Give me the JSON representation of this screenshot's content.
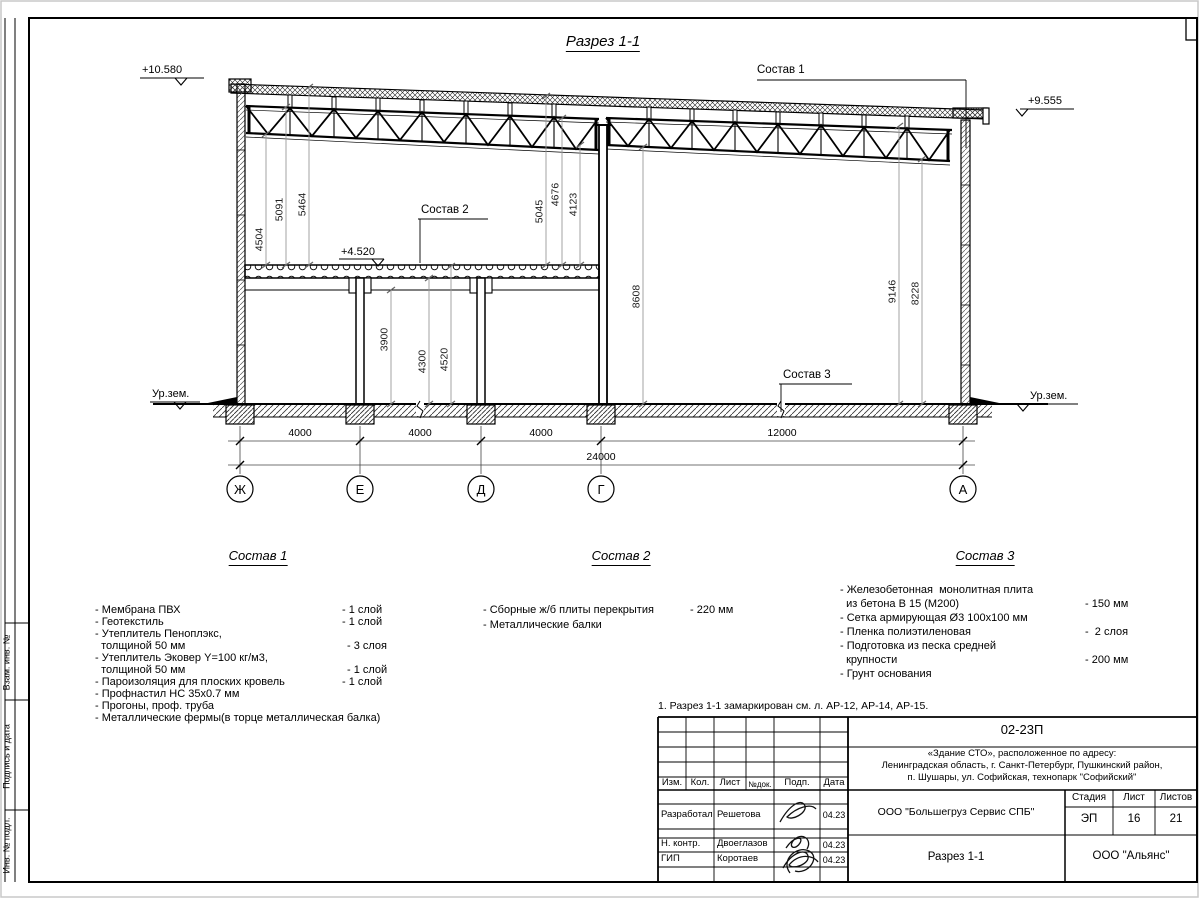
{
  "sheet": {
    "title": "Разрез 1-1",
    "note": "1. Разрез 1-1 замаркирован см. л. АР-12, АР-14, АР-15.",
    "margin_labels": [
      "Взам. инв. №",
      "Подпись и дата",
      "Инв. № подл."
    ]
  },
  "drawing": {
    "elevations": {
      "roof_left": "+10.580",
      "roof_right": "+9.555",
      "slab": "+4.520",
      "ground_left": "Ур.зем.",
      "ground_right": "Ур.зем."
    },
    "callouts": [
      "Состав 1",
      "Состав 2",
      "Состав 3"
    ],
    "vdims": [
      "4504",
      "5091",
      "5464",
      "5045",
      "4676",
      "4123",
      "3900",
      "4300",
      "4520",
      "8608",
      "9146",
      "8228"
    ],
    "hdims": [
      "4000",
      "4000",
      "4000",
      "12000"
    ],
    "total_dim": "24000",
    "axes": [
      "Ж",
      "Е",
      "Д",
      "Г",
      "А"
    ]
  },
  "compositions": [
    {
      "title": "Состав 1",
      "items": [
        {
          "name": "- Мембрана ПВХ",
          "value": "- 1 слой"
        },
        {
          "name": "- Геотекстиль",
          "value": "- 1 слой"
        },
        {
          "name": "- Утеплитель Пеноплэкс,",
          "value": ""
        },
        {
          "name": "  толщиной 50 мм",
          "value": "- 3 слоя"
        },
        {
          "name": "- Утеплитель Эковер Y=100 кг/м3,",
          "value": ""
        },
        {
          "name": "  толщиной 50 мм",
          "value": "- 1 слой"
        },
        {
          "name": "- Пароизоляция для плоских кровель",
          "value": "- 1 слой"
        },
        {
          "name": "- Профнастил НС 35x0.7 мм",
          "value": ""
        },
        {
          "name": "- Прогоны, проф. труба",
          "value": ""
        },
        {
          "name": "- Металлические фермы(в торце металлическая балка)",
          "value": ""
        }
      ]
    },
    {
      "title": "Состав 2",
      "items": [
        {
          "name": "- Сборные ж/б плиты перекрытия",
          "value": "- 220 мм"
        },
        {
          "name": "- Металлические балки",
          "value": ""
        }
      ]
    },
    {
      "title": "Состав 3",
      "items": [
        {
          "name": "- Железобетонная  монолитная плита",
          "value": ""
        },
        {
          "name": "  из бетона В 15 (М200)",
          "value": "- 150 мм"
        },
        {
          "name": "- Сетка армирующая Ø3 100х100 мм",
          "value": ""
        },
        {
          "name": "- Пленка полиэтиленовая",
          "value": "-  2 слоя"
        },
        {
          "name": "- Подготовка из песка средней",
          "value": ""
        },
        {
          "name": "  крупности",
          "value": "- 200 мм"
        },
        {
          "name": "- Грунт основания",
          "value": ""
        }
      ]
    }
  ],
  "title_block": {
    "doc_number": "02-23П",
    "object_line1": "«Здание СТО», расположенное по адресу:",
    "object_line2": "Ленинградская область, г. Санкт-Петербург, Пушкинский район,",
    "object_line3": "п. Шушары, ул. Софийская, технопарк \"Софийский\"",
    "col_headers": [
      "Изм.",
      "Кол.",
      "Лист",
      "№док.",
      "Подп.",
      "Дата"
    ],
    "sign_rows": [
      {
        "role": "Разработал",
        "name": "Решетова",
        "date": "04.23"
      },
      {
        "role": "Н. контр.",
        "name": "Двоеглазов",
        "date": "04.23"
      },
      {
        "role": "ГИП",
        "name": "Коротаев",
        "date": "04.23"
      }
    ],
    "company": "ООО \"Большегруз Сервис СПБ\"",
    "drawing_title": "Разрез 1-1",
    "org": "ООО \"Альянс\"",
    "stage_header": [
      "Стадия",
      "Лист",
      "Листов"
    ],
    "stage": "ЭП",
    "sheet_number": "16",
    "sheets_total": "21"
  }
}
